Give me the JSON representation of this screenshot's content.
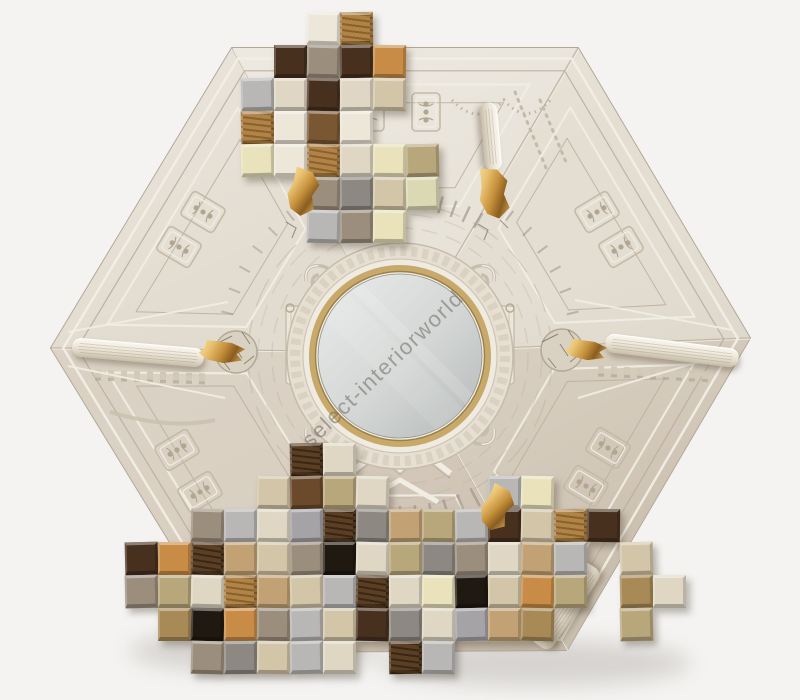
{
  "product_photo": {
    "watermark_text": "select-interiorworld",
    "watermark_color": "rgba(108,104,99,0.55)",
    "background_color": "#F4F3F1",
    "frame": {
      "shape": "hexagon",
      "base_color": "#DCD5C8",
      "edge_dark": "#B3A898",
      "edge_light": "#F2EEE5",
      "line_dark": "#BBB0A0",
      "line_light": "#F1EDE3",
      "relief_shadow": "#A79C89",
      "relief_light": "#F2EDE3",
      "wedge_fills": [
        "#E8E3D9",
        "#E4DED2",
        "#D9CFC0",
        "#D5CABB",
        "#DAD1C3",
        "#E2DBCF"
      ]
    },
    "mirror": {
      "glass_light": "#E9ECEA",
      "glass_dark": "#B4B8B6",
      "rim_gold": "#C6A96B",
      "rim_gold_dark": "#9C7F45",
      "rim_gold_light": "#E9D9A8",
      "ring_white": "#F0EBE1",
      "boss_fill": "#E6DFD2"
    },
    "gold_accent": {
      "light": "#F6DE9F",
      "mid": "#C6913C",
      "dark": "#8A5D20"
    },
    "cube_palette": {
      "ivory": "#EDE7D9",
      "cream": "#DFD7C4",
      "paleyel": "#E9E2BB",
      "sage": "#DBD9B4",
      "khaki": "#B9A77C",
      "beige": "#D3C6A8",
      "tan": "#C2A275",
      "orange": "#C88C46",
      "bronze": "#A88A57",
      "taupe": "#9B8E7C",
      "gray": "#8D8982",
      "silver": "#B8B7B5",
      "slate": "#A5A3A6",
      "midbrown": "#7A5733",
      "brown": "#6B4A2C",
      "dkbrown": "#47301E",
      "black": "#201911",
      "wood": "#B08449",
      "wood_stripe": "#8A6128",
      "dkwood": "#5A3F24",
      "dkwood_stripe": "#392614"
    },
    "mosaic_top": {
      "origin": [
        241,
        12
      ],
      "cell": 33,
      "cubes": [
        [
          2,
          0,
          "ivory"
        ],
        [
          3,
          0,
          "wood"
        ],
        [
          1,
          1,
          "dkbrown"
        ],
        [
          2,
          1,
          "taupe"
        ],
        [
          3,
          1,
          "dkbrown"
        ],
        [
          4,
          1,
          "orange"
        ],
        [
          0,
          2,
          "silver"
        ],
        [
          1,
          2,
          "cream"
        ],
        [
          2,
          2,
          "dkbrown"
        ],
        [
          3,
          2,
          "cream"
        ],
        [
          4,
          2,
          "beige"
        ],
        [
          0,
          3,
          "wood"
        ],
        [
          1,
          3,
          "ivory"
        ],
        [
          2,
          3,
          "midbrown"
        ],
        [
          3,
          3,
          "ivory"
        ],
        [
          0,
          4,
          "paleyel"
        ],
        [
          1,
          4,
          "ivory"
        ],
        [
          2,
          4,
          "wood"
        ],
        [
          3,
          4,
          "cream"
        ],
        [
          4,
          4,
          "paleyel"
        ],
        [
          5,
          4,
          "khaki"
        ],
        [
          2,
          5,
          "taupe"
        ],
        [
          3,
          5,
          "gray"
        ],
        [
          4,
          5,
          "beige"
        ],
        [
          5,
          5,
          "sage"
        ],
        [
          2,
          6,
          "silver"
        ],
        [
          3,
          6,
          "taupe"
        ],
        [
          4,
          6,
          "paleyel"
        ]
      ]
    },
    "mosaic_bottom": {
      "origin": [
        125,
        443
      ],
      "cell": 33,
      "cubes": [
        [
          5,
          0,
          "dkwood"
        ],
        [
          6,
          0,
          "cream"
        ],
        [
          4,
          1,
          "beige"
        ],
        [
          5,
          1,
          "brown"
        ],
        [
          6,
          1,
          "khaki"
        ],
        [
          7,
          1,
          "cream"
        ],
        [
          11,
          1,
          "silver"
        ],
        [
          12,
          1,
          "paleyel"
        ],
        [
          2,
          2,
          "taupe"
        ],
        [
          3,
          2,
          "silver"
        ],
        [
          4,
          2,
          "cream"
        ],
        [
          5,
          2,
          "slate"
        ],
        [
          6,
          2,
          "dkwood"
        ],
        [
          7,
          2,
          "gray"
        ],
        [
          8,
          2,
          "tan"
        ],
        [
          9,
          2,
          "khaki"
        ],
        [
          10,
          2,
          "silver"
        ],
        [
          11,
          2,
          "dkbrown"
        ],
        [
          12,
          2,
          "beige"
        ],
        [
          13,
          2,
          "wood"
        ],
        [
          14,
          2,
          "dkbrown"
        ],
        [
          0,
          3,
          "dkbrown"
        ],
        [
          1,
          3,
          "orange"
        ],
        [
          2,
          3,
          "dkwood"
        ],
        [
          3,
          3,
          "tan"
        ],
        [
          4,
          3,
          "beige"
        ],
        [
          5,
          3,
          "taupe"
        ],
        [
          6,
          3,
          "black"
        ],
        [
          7,
          3,
          "cream"
        ],
        [
          8,
          3,
          "khaki"
        ],
        [
          9,
          3,
          "gray"
        ],
        [
          10,
          3,
          "taupe"
        ],
        [
          11,
          3,
          "cream"
        ],
        [
          12,
          3,
          "tan"
        ],
        [
          13,
          3,
          "silver"
        ],
        [
          15,
          3,
          "beige"
        ],
        [
          0,
          4,
          "taupe"
        ],
        [
          1,
          4,
          "khaki"
        ],
        [
          2,
          4,
          "cream"
        ],
        [
          3,
          4,
          "wood"
        ],
        [
          4,
          4,
          "tan"
        ],
        [
          5,
          4,
          "beige"
        ],
        [
          6,
          4,
          "silver"
        ],
        [
          7,
          4,
          "dkwood"
        ],
        [
          8,
          4,
          "cream"
        ],
        [
          9,
          4,
          "paleyel"
        ],
        [
          10,
          4,
          "black"
        ],
        [
          11,
          4,
          "beige"
        ],
        [
          12,
          4,
          "orange"
        ],
        [
          13,
          4,
          "khaki"
        ],
        [
          15,
          4,
          "bronze"
        ],
        [
          16,
          4,
          "cream"
        ],
        [
          1,
          5,
          "bronze"
        ],
        [
          2,
          5,
          "black"
        ],
        [
          3,
          5,
          "orange"
        ],
        [
          4,
          5,
          "taupe"
        ],
        [
          5,
          5,
          "silver"
        ],
        [
          6,
          5,
          "beige"
        ],
        [
          7,
          5,
          "dkbrown"
        ],
        [
          8,
          5,
          "gray"
        ],
        [
          9,
          5,
          "cream"
        ],
        [
          10,
          5,
          "slate"
        ],
        [
          11,
          5,
          "tan"
        ],
        [
          12,
          5,
          "bronze"
        ],
        [
          15,
          5,
          "khaki"
        ],
        [
          2,
          6,
          "taupe"
        ],
        [
          3,
          6,
          "gray"
        ],
        [
          4,
          6,
          "beige"
        ],
        [
          5,
          6,
          "silver"
        ],
        [
          6,
          6,
          "cream"
        ],
        [
          8,
          6,
          "dkwood"
        ],
        [
          9,
          6,
          "silver"
        ]
      ]
    },
    "gold_ornaments": [
      {
        "x": 303,
        "y": 192,
        "w": 30,
        "h": 48,
        "rot": 10
      },
      {
        "x": 494,
        "y": 193,
        "w": 30,
        "h": 52,
        "rot": -8
      },
      {
        "x": 222,
        "y": 352,
        "w": 46,
        "h": 22,
        "rot": 4
      },
      {
        "x": 586,
        "y": 350,
        "w": 42,
        "h": 20,
        "rot": 5
      },
      {
        "x": 497,
        "y": 508,
        "w": 30,
        "h": 46,
        "rot": 20
      }
    ],
    "baton_ornaments": [
      {
        "x": 138,
        "y": 352,
        "len": 132,
        "th": 19,
        "rot": 5
      },
      {
        "x": 672,
        "y": 350,
        "len": 134,
        "th": 19,
        "rot": 7
      },
      {
        "x": 303,
        "y": 136,
        "len": 68,
        "th": 17,
        "rot": 95
      },
      {
        "x": 491,
        "y": 136,
        "len": 68,
        "th": 17,
        "rot": 85
      },
      {
        "x": 566,
        "y": 606,
        "len": 96,
        "th": 24,
        "rot": -56
      },
      {
        "x": 452,
        "y": 623,
        "len": 82,
        "th": 20,
        "rot": -62
      }
    ]
  }
}
